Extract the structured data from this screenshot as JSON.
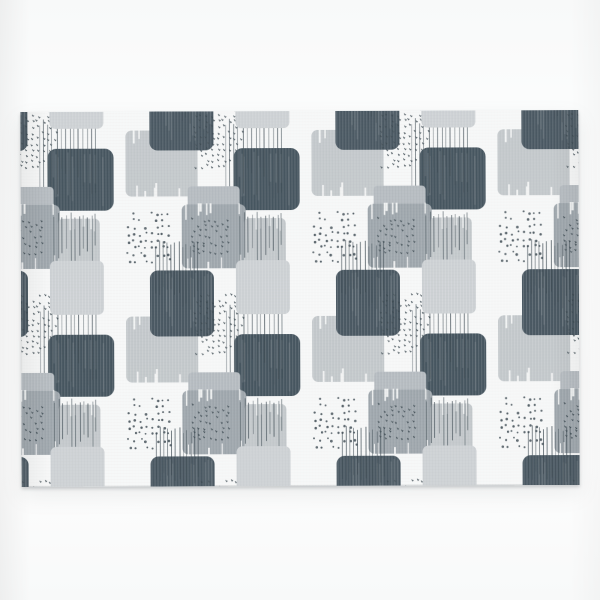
{
  "scene": {
    "type": "product-photo",
    "subject": "Rectangular rug with abstract grey brush-stroke squares pattern on white fabric",
    "backdrop": "plain white studio wall and floor"
  },
  "canvas": {
    "width": 600,
    "height": 600
  },
  "rug": {
    "left": 21,
    "top": 111,
    "width": 558,
    "height": 375,
    "rotation_deg": -0.2,
    "base_color": "#f6f7f7"
  },
  "palette": {
    "dark": "#4b5963",
    "darkDeep": "#475660",
    "med": "#9ea6ac",
    "medLight": "#b5bbc0",
    "light": "#c3c8cb",
    "lighter": "#cdd1d4",
    "ink": "#3d4a52",
    "base": "#f6f7f7",
    "wall": "#fcfdfd",
    "shadow": "#6e7478"
  },
  "pattern_tile": {
    "size": 186,
    "offset_x": -81,
    "offset_y": -19,
    "elements": [
      {
        "type": "square",
        "name": "light-brush-a",
        "x": 0,
        "y": 38,
        "w": 72,
        "h": 66,
        "rx": 6,
        "color": "light",
        "streaks": "white",
        "seed": 11
      },
      {
        "type": "square",
        "name": "dark-square-top",
        "x": 24,
        "y": -8,
        "w": 64,
        "h": 66,
        "rx": 8,
        "color": "dark",
        "streaks": "faint",
        "seed": 12,
        "copies": [
          {
            "dx": 0,
            "dy": 186
          }
        ]
      },
      {
        "type": "dots",
        "name": "speckle-ticks-a",
        "x": 66,
        "y": 14,
        "w": 52,
        "h": 62,
        "style": "ticks",
        "cols": 9,
        "rows": 11,
        "seed": 21
      },
      {
        "type": "square",
        "name": "dark-square-big",
        "x": 108,
        "y": 56,
        "w": 66,
        "h": 62,
        "rx": 9,
        "color": "darkDeep",
        "streaks": "faint",
        "seed": 13
      },
      {
        "type": "lines",
        "name": "pinstripes-a",
        "x": 100,
        "y": 26,
        "w": 56,
        "n": 14,
        "lenMin": 44,
        "lenMax": 76,
        "seed": 31
      },
      {
        "type": "square",
        "name": "mid-gray-strip",
        "x": 62,
        "y": 94,
        "w": 52,
        "h": 26,
        "rx": 4,
        "color": "medLight",
        "streaks": "none",
        "seed": 14
      },
      {
        "type": "square",
        "name": "mid-gray-big",
        "x": 56,
        "y": 112,
        "w": 64,
        "h": 64,
        "rx": 6,
        "color": "med",
        "streaks": "white",
        "seed": 15
      },
      {
        "type": "dots",
        "name": "speckle-round-b",
        "x": 0,
        "y": 118,
        "w": 46,
        "h": 54,
        "style": "round",
        "cols": 8,
        "rows": 8,
        "seed": 22
      },
      {
        "type": "square",
        "name": "light-brush-b",
        "x": 118,
        "y": 126,
        "w": 42,
        "h": 54,
        "rx": 5,
        "color": "light",
        "streaks": "white",
        "seed": 16
      },
      {
        "type": "dots",
        "name": "speckle-ticks-c",
        "x": 64,
        "y": 124,
        "w": 40,
        "h": 38,
        "style": "ticks",
        "cols": 7,
        "rows": 7,
        "seed": 23
      },
      {
        "type": "lines",
        "name": "pinstripes-c",
        "x": 114,
        "y": 118,
        "w": 42,
        "n": 11,
        "lenMin": 30,
        "lenMax": 56,
        "seed": 33
      },
      {
        "type": "square",
        "name": "light-gray-c",
        "x": 110,
        "y": 168,
        "w": 54,
        "h": 54,
        "rx": 6,
        "color": "lighter",
        "streaks": "none",
        "seed": 17,
        "copies": [
          {
            "dx": 0,
            "dy": -186
          }
        ]
      },
      {
        "type": "lines",
        "name": "pinstripes-b",
        "x": 30,
        "y": 148,
        "w": 42,
        "n": 12,
        "lenMin": 40,
        "lenMax": 66,
        "seed": 32,
        "copies": [
          {
            "dx": 0,
            "dy": -186
          }
        ]
      }
    ]
  }
}
